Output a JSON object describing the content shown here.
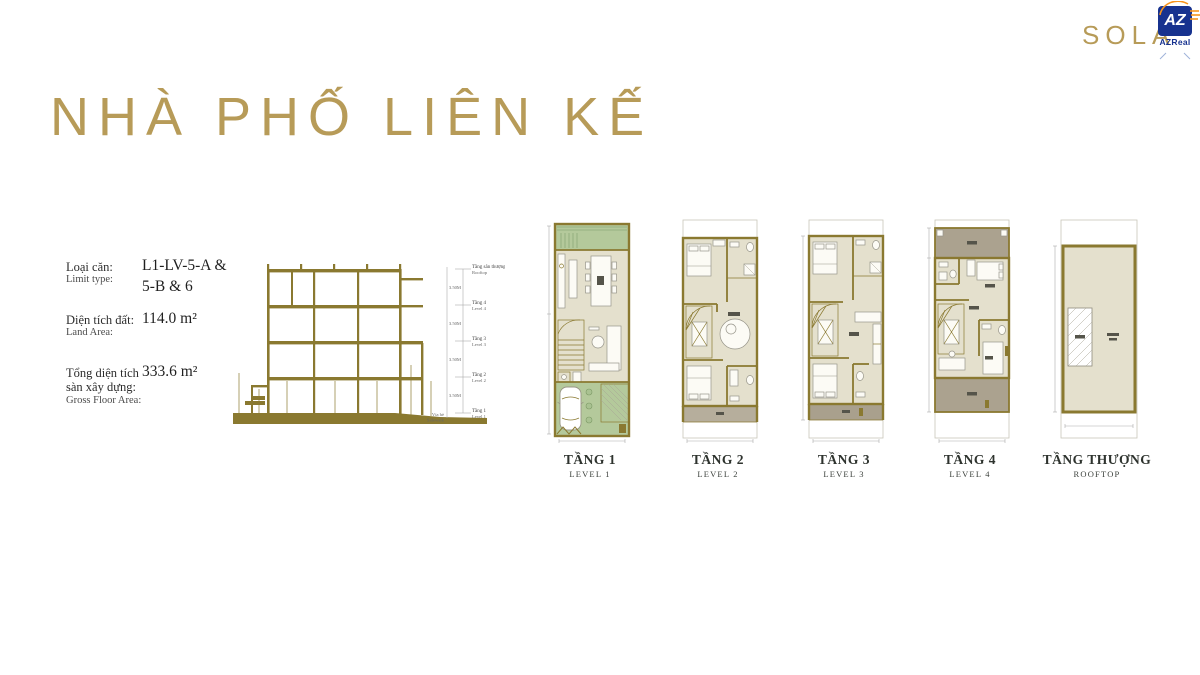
{
  "branding": {
    "sola": "SOLA",
    "az_abbr": "AZ",
    "az_name": "AZReal"
  },
  "title": "NHÀ PHỐ LIÊN KẾ",
  "info": {
    "rows": [
      {
        "label_vn": "Loại căn:",
        "label_en": "Limit type:",
        "value": "L1-LV-5-A & 5-B & 6"
      },
      {
        "label_vn": "Diện tích đất:",
        "label_en": "Land Area:",
        "value": "114.0 m²"
      },
      {
        "label_vn": "Tổng diện tích sàn xây dựng:",
        "label_en": "Gross Floor Area:",
        "value": "333.6 m²"
      }
    ]
  },
  "section": {
    "levels": [
      {
        "vn": "Tầng sân thượng",
        "en": "Rooftop"
      },
      {
        "vn": "Tầng 4",
        "en": "Level 4"
      },
      {
        "vn": "Tầng 3",
        "en": "Level 3"
      },
      {
        "vn": "Tầng 2",
        "en": "Level 2"
      },
      {
        "vn": "Tầng 1",
        "en": "Level 1"
      }
    ],
    "floor_height": "3.50M",
    "ground_vn": "Vỉa hè",
    "ground_en": "Sidewalk"
  },
  "plans": [
    {
      "vn": "TẦNG 1",
      "en": "LEVEL 1"
    },
    {
      "vn": "TẦNG 2",
      "en": "LEVEL 2"
    },
    {
      "vn": "TẦNG 3",
      "en": "LEVEL 3"
    },
    {
      "vn": "TẦNG 4",
      "en": "LEVEL 4"
    },
    {
      "vn": "TẦNG THƯỢNG",
      "en": "ROOFTOP"
    }
  ],
  "colors": {
    "gold": "#b79b58",
    "wall": "#8a7930",
    "beige": "#e4e0cd",
    "green": "#b4c99b",
    "terrace": "#aba28f",
    "balcony": "#b6ae9c",
    "az_blue": "#17328f",
    "az_orange": "#f7941d"
  }
}
